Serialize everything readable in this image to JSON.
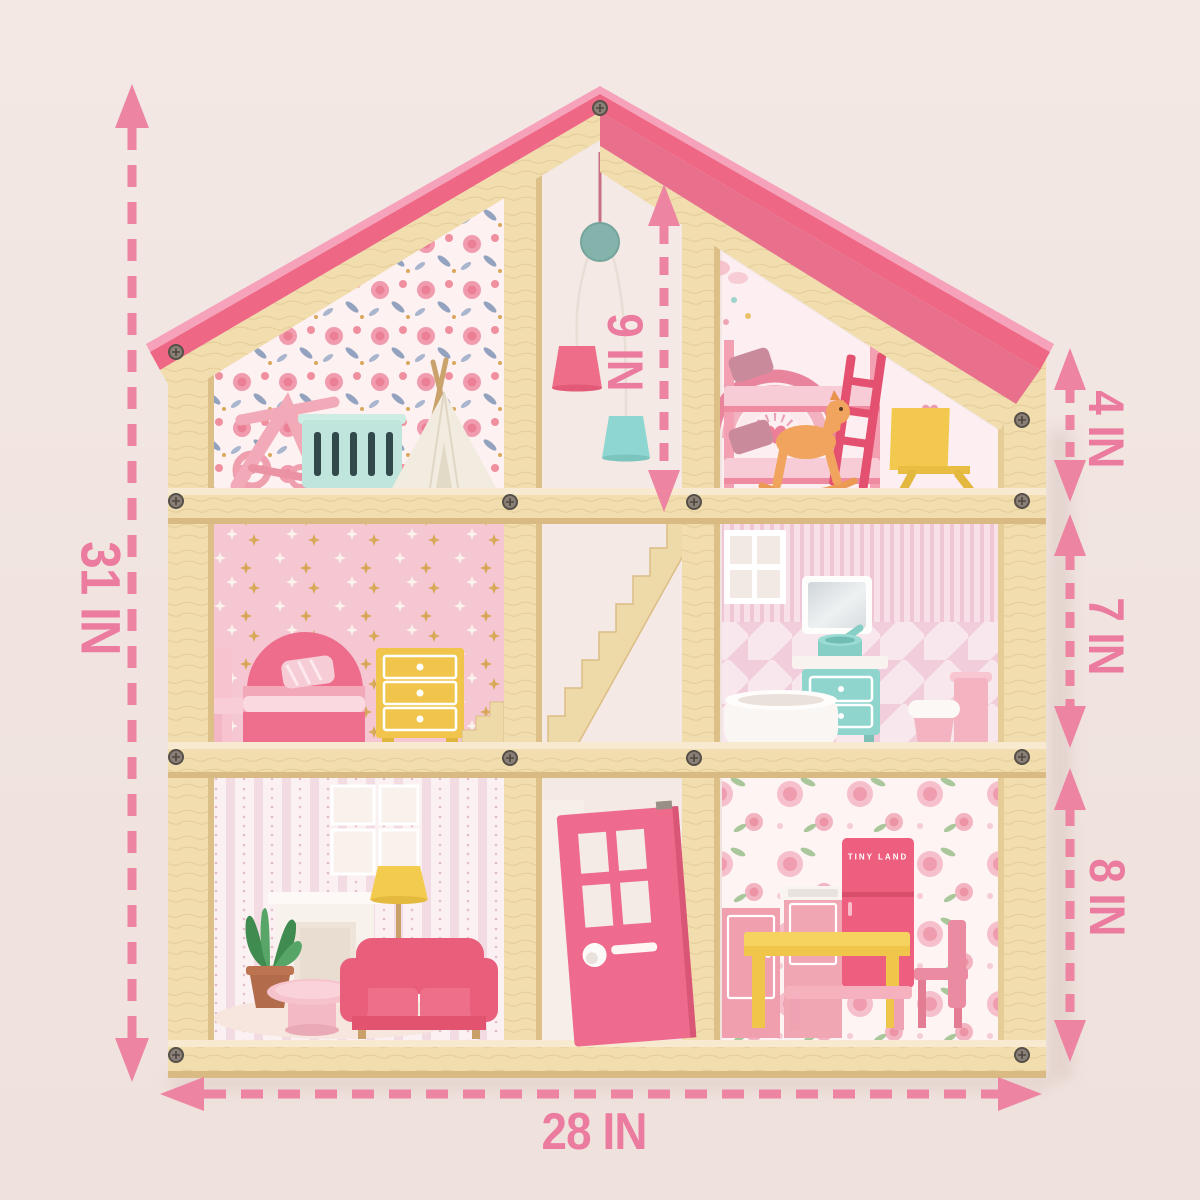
{
  "image_type": "product-dimension-illustration",
  "subject": "Three-story wooden dollhouse with furniture and dimension arrows",
  "background_color": "#f1e5e1",
  "colors": {
    "dimension_pink": "#ec84a2",
    "label_pink": "#ec7ba0",
    "roof_pink": "#ee6886",
    "wood": "#f1ddae",
    "door_pink": "#ee6b8d",
    "fridge_pink": "#ee5f7f",
    "accent_teal": "#8fd4cd",
    "accent_yellow": "#f2ca4e",
    "sofa_pink": "#e85e7b"
  },
  "annotations": {
    "overall_height": {
      "text": "31 IN",
      "orientation": "vertical",
      "position": "left"
    },
    "overall_width": {
      "text": "28 IN",
      "orientation": "horizontal",
      "position": "bottom"
    },
    "attic_interior_height": {
      "text": "9 IN",
      "orientation": "vertical",
      "position": "attic-center"
    },
    "attic_wall_height": {
      "text": "4 IN",
      "orientation": "vertical",
      "position": "right-top"
    },
    "middle_floor_height": {
      "text": "7 IN",
      "orientation": "vertical",
      "position": "right-middle"
    },
    "ground_floor_height": {
      "text": "8 IN",
      "orientation": "vertical",
      "position": "right-bottom"
    }
  },
  "branding": {
    "fridge_logo_text": "TINY LAND"
  },
  "rooms": [
    {
      "name": "nursery-attic",
      "items": [
        "stroller",
        "crib",
        "teepee"
      ]
    },
    {
      "name": "kids-bedroom-attic",
      "items": [
        "rainbow-mural",
        "bunk-bed",
        "rocking-horse",
        "easel"
      ]
    },
    {
      "name": "stair-hall",
      "items": [
        "hanging-mobile",
        "pendant-lamps",
        "staircase",
        "front-door"
      ]
    },
    {
      "name": "bedroom",
      "items": [
        "armchair",
        "arch-bed",
        "yellow-dresser"
      ]
    },
    {
      "name": "bathroom",
      "items": [
        "window",
        "mirror",
        "sink-vanity",
        "bathtub",
        "toilet"
      ]
    },
    {
      "name": "living-room",
      "items": [
        "picture-frames",
        "fireplace",
        "potted-plant",
        "floor-lamp",
        "sofa",
        "coffee-table",
        "rug"
      ]
    },
    {
      "name": "kitchen",
      "items": [
        "cabinet",
        "sink",
        "fridge",
        "dining-table",
        "bench",
        "chair"
      ]
    }
  ]
}
